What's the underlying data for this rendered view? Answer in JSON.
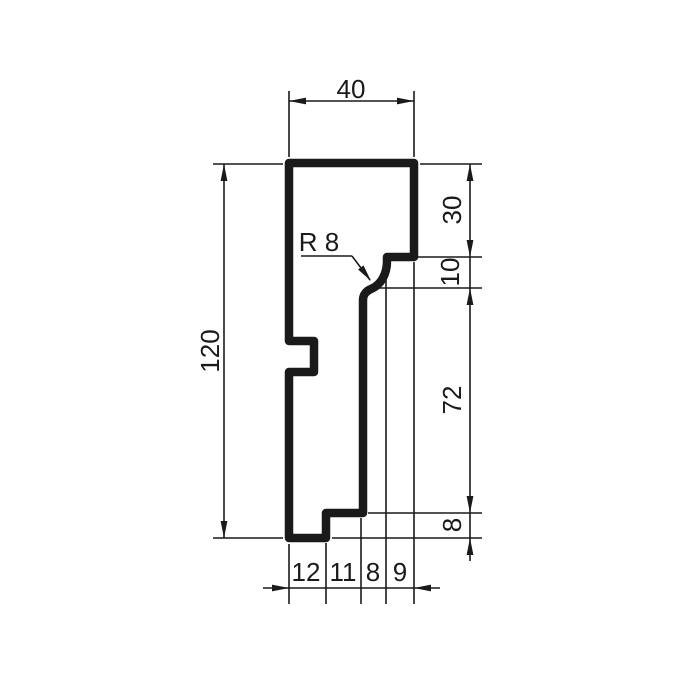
{
  "drawing": {
    "description": "Technical cross-section drawing of a moulding profile with dimensions",
    "canvas": {
      "width": 686,
      "height": 686,
      "background": "#ffffff"
    },
    "line_color": "#1a1a1a",
    "dimension_values": {
      "top_width": "40",
      "left_height": "120",
      "right_side_top_to_bottom": [
        "30",
        "10",
        "72",
        "8"
      ],
      "bottom_left_to_right": [
        "12",
        "11",
        "8",
        "9"
      ],
      "radius_callout": "R 8"
    },
    "profile": {
      "name": "profile-outline",
      "stroke_width": 8.5,
      "outline_path": "M 289 163 H 414 V 257 H 387 V 261 C 387 274 381 285 371 289 C 366 291 363 295 363 300 V 513 H 326 V 538 H 289 V 372 H 314 V 341 H 289 Z"
    },
    "thin_line_width": 1.6,
    "extension_lines": [
      {
        "id": "ext-top-left",
        "x1": 289,
        "y1": 91,
        "x2": 289,
        "y2": 157
      },
      {
        "id": "ext-top-right",
        "x1": 414,
        "y1": 91,
        "x2": 414,
        "y2": 157
      },
      {
        "id": "ext-left-upper",
        "x1": 213,
        "y1": 164,
        "x2": 283,
        "y2": 164
      },
      {
        "id": "ext-left-lower",
        "x1": 213,
        "y1": 538,
        "x2": 283,
        "y2": 538
      },
      {
        "id": "ext-right-top",
        "x1": 420,
        "y1": 164,
        "x2": 482,
        "y2": 164
      },
      {
        "id": "ext-right-step",
        "x1": 418,
        "y1": 257,
        "x2": 482,
        "y2": 257
      },
      {
        "id": "ext-right-curve-end",
        "x1": 378,
        "y1": 288,
        "x2": 482,
        "y2": 288
      },
      {
        "id": "ext-right-lower-step",
        "x1": 368,
        "y1": 513,
        "x2": 482,
        "y2": 513
      },
      {
        "id": "ext-right-bottom",
        "x1": 332,
        "y1": 538,
        "x2": 482,
        "y2": 538
      },
      {
        "id": "ext-bottom-1",
        "x1": 289,
        "y1": 544,
        "x2": 289,
        "y2": 604
      },
      {
        "id": "ext-bottom-2",
        "x1": 326,
        "y1": 543,
        "x2": 326,
        "y2": 604
      },
      {
        "id": "ext-bottom-3",
        "x1": 361,
        "y1": 518,
        "x2": 361,
        "y2": 604
      },
      {
        "id": "ext-bottom-4",
        "x1": 386,
        "y1": 267,
        "x2": 386,
        "y2": 604
      },
      {
        "id": "ext-bottom-5",
        "x1": 414,
        "y1": 262,
        "x2": 414,
        "y2": 604
      }
    ],
    "dimension_lines": [
      {
        "id": "dimline-top",
        "x1": 289,
        "y1": 101,
        "x2": 414,
        "y2": 101
      },
      {
        "id": "dimline-left",
        "x1": 224,
        "y1": 164,
        "x2": 224,
        "y2": 538
      },
      {
        "id": "dimline-right",
        "x1": 470,
        "y1": 164,
        "x2": 470,
        "y2": 538
      },
      {
        "id": "dimline-right-stub",
        "x1": 470,
        "y1": 538,
        "x2": 470,
        "y2": 561
      },
      {
        "id": "dimline-bottom",
        "x1": 263,
        "y1": 588,
        "x2": 440,
        "y2": 588
      }
    ],
    "leader_lines": [
      {
        "id": "radius-underline",
        "x1": 301,
        "y1": 256,
        "x2": 352,
        "y2": 256
      },
      {
        "id": "radius-leader",
        "x1": 352,
        "y1": 256,
        "x2": 370,
        "y2": 280
      }
    ],
    "arrowheads": [
      {
        "id": "arrow-top-left",
        "x": 289,
        "y": 101,
        "angle": 180
      },
      {
        "id": "arrow-top-right",
        "x": 414,
        "y": 101,
        "angle": 0
      },
      {
        "id": "arrow-left-up",
        "x": 224,
        "y": 164,
        "angle": 270
      },
      {
        "id": "arrow-left-down",
        "x": 224,
        "y": 538,
        "angle": 90
      },
      {
        "id": "arrow-right-164-up",
        "x": 470,
        "y": 164,
        "angle": 270
      },
      {
        "id": "arrow-right-257-down",
        "x": 470,
        "y": 257,
        "angle": 90
      },
      {
        "id": "arrow-right-288-up",
        "x": 470,
        "y": 288,
        "angle": 270
      },
      {
        "id": "arrow-right-513-down",
        "x": 470,
        "y": 513,
        "angle": 90
      },
      {
        "id": "arrow-right-538-up",
        "x": 470,
        "y": 538,
        "angle": 270
      },
      {
        "id": "arrow-bottom-left",
        "x": 289,
        "y": 588,
        "angle": 0
      },
      {
        "id": "arrow-bottom-right",
        "x": 414,
        "y": 588,
        "angle": 180
      },
      {
        "id": "arrow-radius-leader",
        "x": 371,
        "y": 281,
        "angle": 53
      }
    ],
    "arrow_geometry": {
      "length": 17,
      "half_width": 3.4
    },
    "labels": [
      {
        "id": "dimension-label-top-width",
        "text": "40",
        "x": 351,
        "y": 89,
        "rot": 0
      },
      {
        "id": "dimension-label-left-height",
        "text": "120",
        "x": 210,
        "y": 351,
        "rot": -90
      },
      {
        "id": "dimension-label-right-30",
        "text": "30",
        "x": 452,
        "y": 210,
        "rot": -90
      },
      {
        "id": "dimension-label-right-10",
        "text": "10",
        "x": 450,
        "y": 272,
        "rot": -90
      },
      {
        "id": "dimension-label-right-72",
        "text": "72",
        "x": 452,
        "y": 400,
        "rot": -90
      },
      {
        "id": "dimension-label-right-8",
        "text": "8",
        "x": 452,
        "y": 525,
        "rot": -90
      },
      {
        "id": "dimension-label-bottom-12",
        "text": "12",
        "x": 306,
        "y": 572,
        "rot": 0
      },
      {
        "id": "dimension-label-bottom-11",
        "text": "11",
        "x": 343,
        "y": 572,
        "rot": 0
      },
      {
        "id": "dimension-label-bottom-8",
        "text": "8",
        "x": 373,
        "y": 572,
        "rot": 0
      },
      {
        "id": "dimension-label-bottom-9",
        "text": "9",
        "x": 400,
        "y": 572,
        "rot": 0
      },
      {
        "id": "radius-label",
        "text": "R 8",
        "x": 319,
        "y": 242,
        "rot": 0
      }
    ]
  }
}
